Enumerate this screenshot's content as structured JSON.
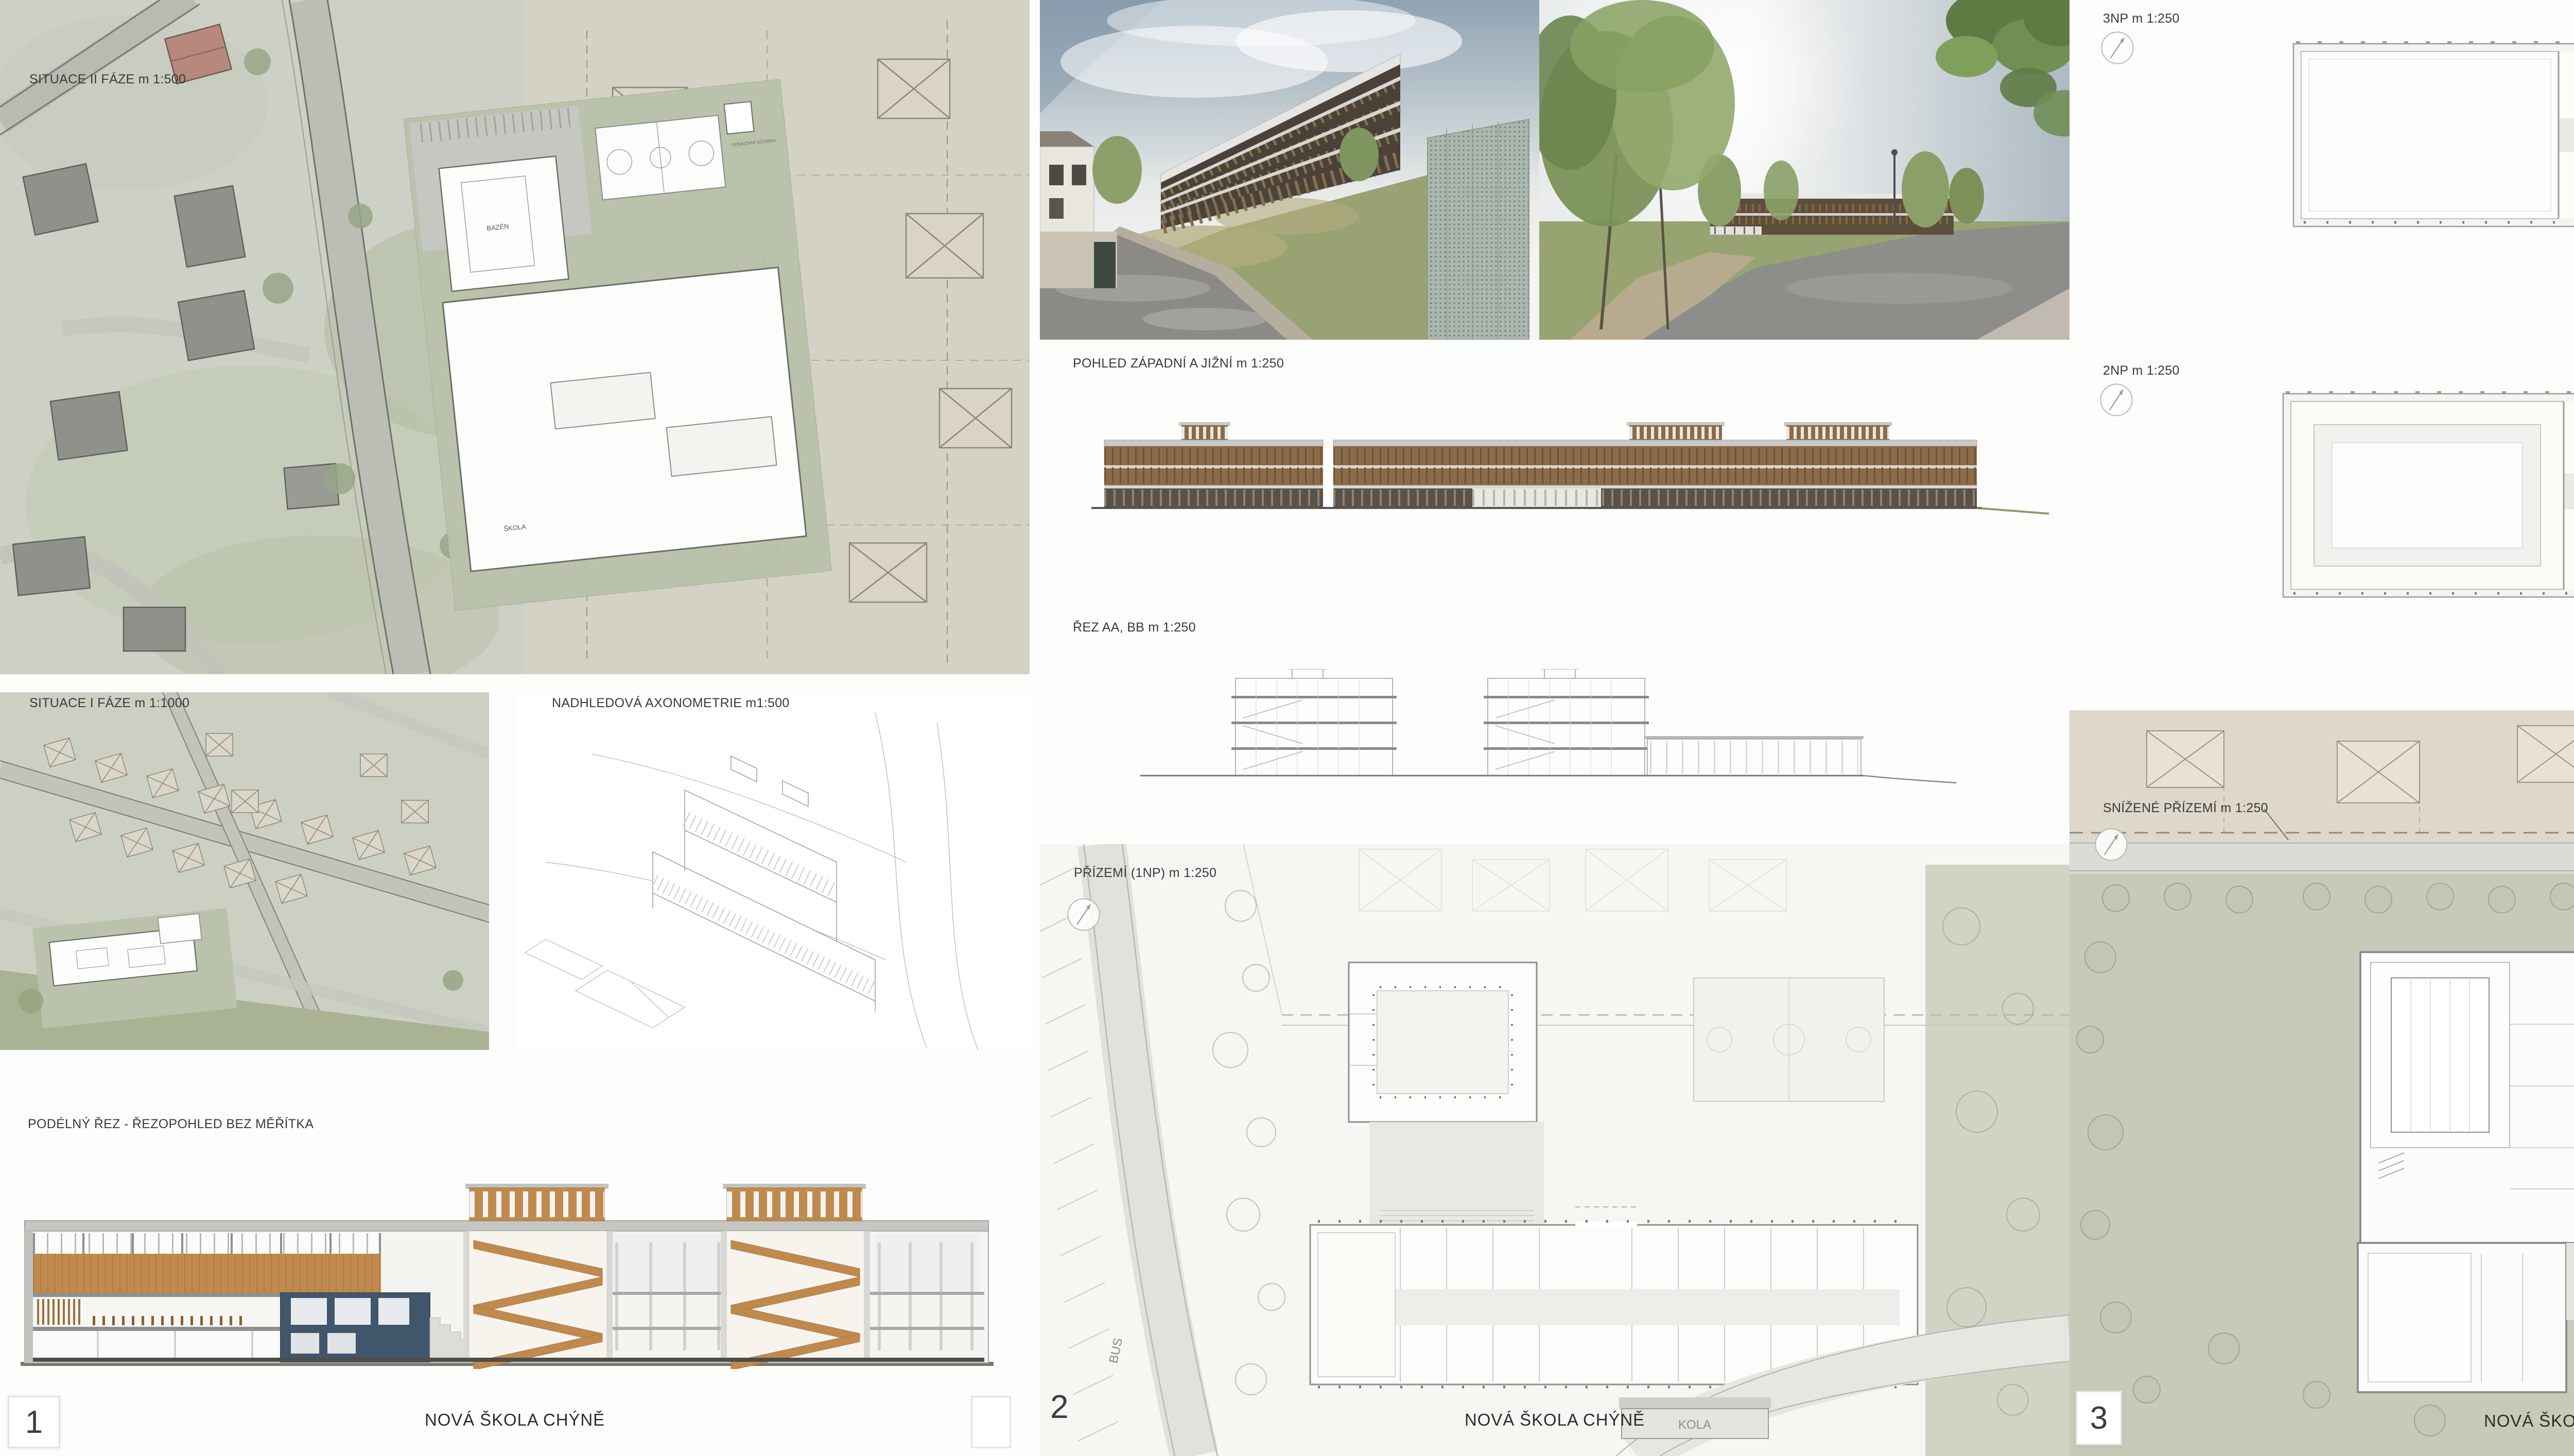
{
  "board": {
    "entry_number": "59",
    "project_title": "NOVÁ ŠKOLA CHÝNĚ"
  },
  "panel1": {
    "number": "1",
    "title": "NOVÁ ŠKOLA CHÝNĚ",
    "labels": {
      "site_phase2": "SITUACE II FÁZE m 1:500",
      "site_phase1": "SITUACE I FÁZE m 1:1000",
      "axonometry": "NADHLEDOVÁ AXONOMETRIE m1:500",
      "long_section": "PODÉLNÝ ŘEZ - ŘEZOPOHLED BEZ MĚŘÍTKA"
    },
    "plan_texts": {
      "pool": "BAZÉN",
      "school": "ŠKOLA",
      "outdoor_classroom": "VENKOVNÍ UČEBNA"
    }
  },
  "panel2": {
    "number": "2",
    "title": "NOVÁ ŠKOLA CHÝNĚ",
    "labels": {
      "elevations": "POHLED ZÁPADNÍ A JIŽNÍ m 1:250",
      "sections": "ŘEZ AA, BB m 1:250",
      "ground_floor": "PŘÍZEMÍ (1NP) m 1:250"
    },
    "plan_texts": {
      "bikes": "KOLA",
      "bus": "BUS"
    }
  },
  "panel3": {
    "number": "3",
    "title": "NOVÁ ŠKOLA CHÝNĚ",
    "labels": {
      "floor3": "3NP m 1:250",
      "floor2": "2NP m 1:250",
      "lowered_ground": "SNÍŽENÉ PŘÍZEMÍ m 1:250"
    },
    "plan_texts": {
      "outdoor_classroom": "VENKOVNÍ UČEBNA"
    }
  },
  "colors": {
    "paper": "#f7f7f4",
    "aerial_base": "#cdd0c5",
    "sage": "#c6cab9",
    "wood_elevation": "#8c6b49",
    "wood_section": "#c08a4e",
    "section_blue": "#41566b",
    "line_grey": "#8f8f8d"
  }
}
